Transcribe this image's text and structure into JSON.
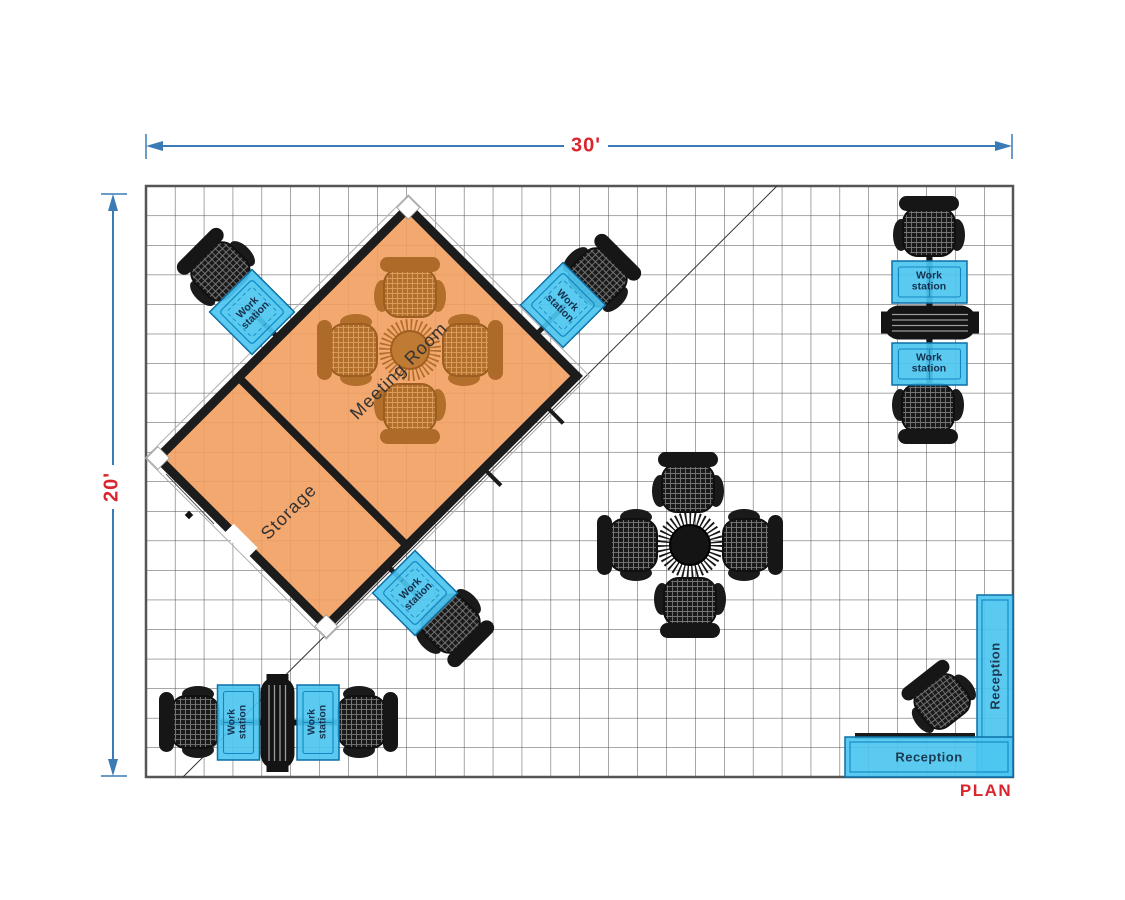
{
  "plan": {
    "title_label": "PLAN",
    "width_dimension": "30'",
    "height_dimension": "20'"
  },
  "rooms": {
    "meeting_room_label": "Meeting Room",
    "storage_label": "Storage"
  },
  "furniture": {
    "workstation_line1": "Work",
    "workstation_line2": "station",
    "workstation_count": 7,
    "reception_label": "Reception",
    "reception_count": 2
  },
  "colors": {
    "room_fill": "#F19F5F",
    "desk_fill": "#4CC5F0",
    "desk_line": "#1287C3",
    "dimension_line": "#3A7AB5",
    "accent_red": "#D9262E",
    "wall": "#1C1C1C",
    "grid_line": "#4C4C4C",
    "brown_furniture": "#B26E2B"
  }
}
